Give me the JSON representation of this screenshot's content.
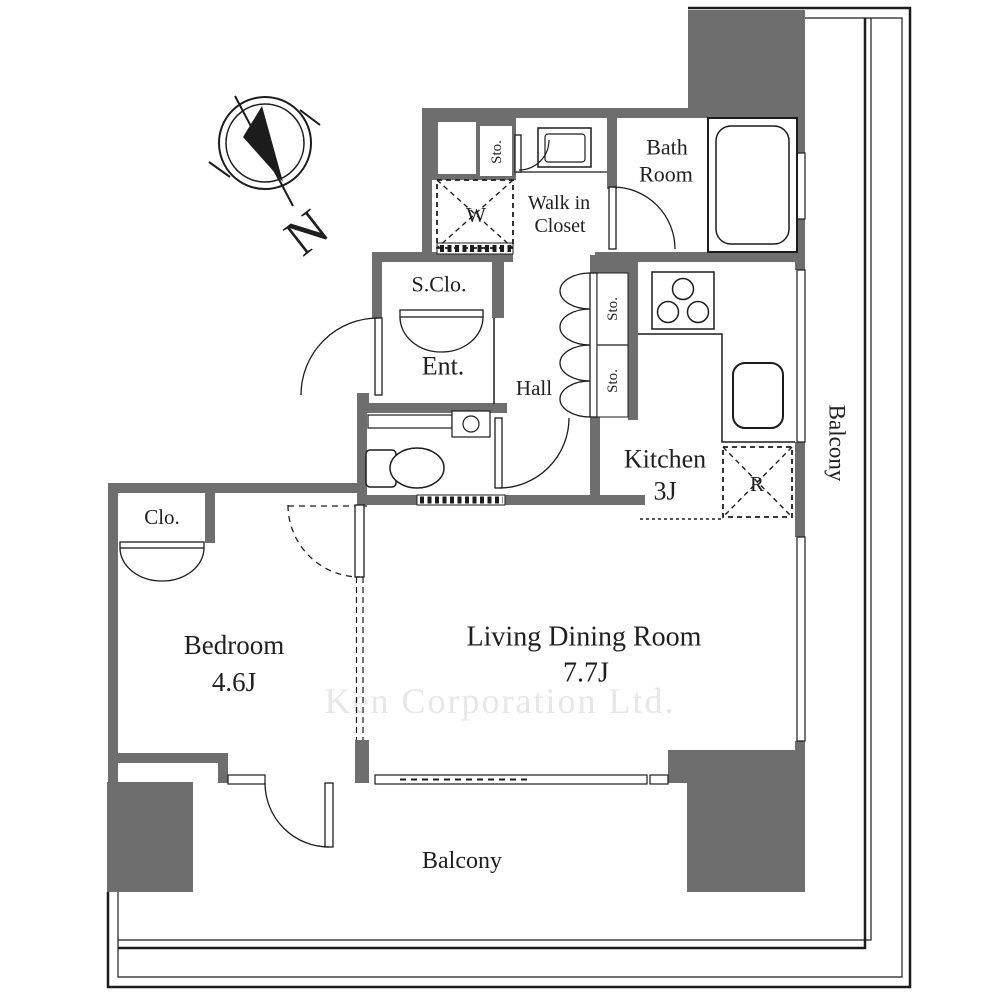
{
  "compass": {
    "north_label": "N"
  },
  "watermark": "Ken Corporation Ltd.",
  "labels": {
    "bath_room": [
      "Bath",
      "Room"
    ],
    "walk_in_closet": [
      "Walk in",
      "Closet"
    ],
    "washer": "W",
    "storage_top": "Sto.",
    "shoe_closet": "S.Clo.",
    "entrance": "Ent.",
    "hall": "Hall",
    "storage_1": "Sto.",
    "storage_2": "Sto.",
    "kitchen_name": "Kitchen",
    "kitchen_size": "3J",
    "refrigerator": "R",
    "closet": "Clo.",
    "bedroom_name": "Bedroom",
    "bedroom_size": "4.6J",
    "living_name": "Living Dining Room",
    "living_size": "7.7J",
    "balcony_right": "Balcony",
    "balcony_bottom": "Balcony"
  },
  "colors": {
    "wall": "#6e6e6e",
    "line": "#1c1c1c",
    "text": "#1f1f1f",
    "watermark": "#e7e7e7",
    "background": "#ffffff"
  }
}
